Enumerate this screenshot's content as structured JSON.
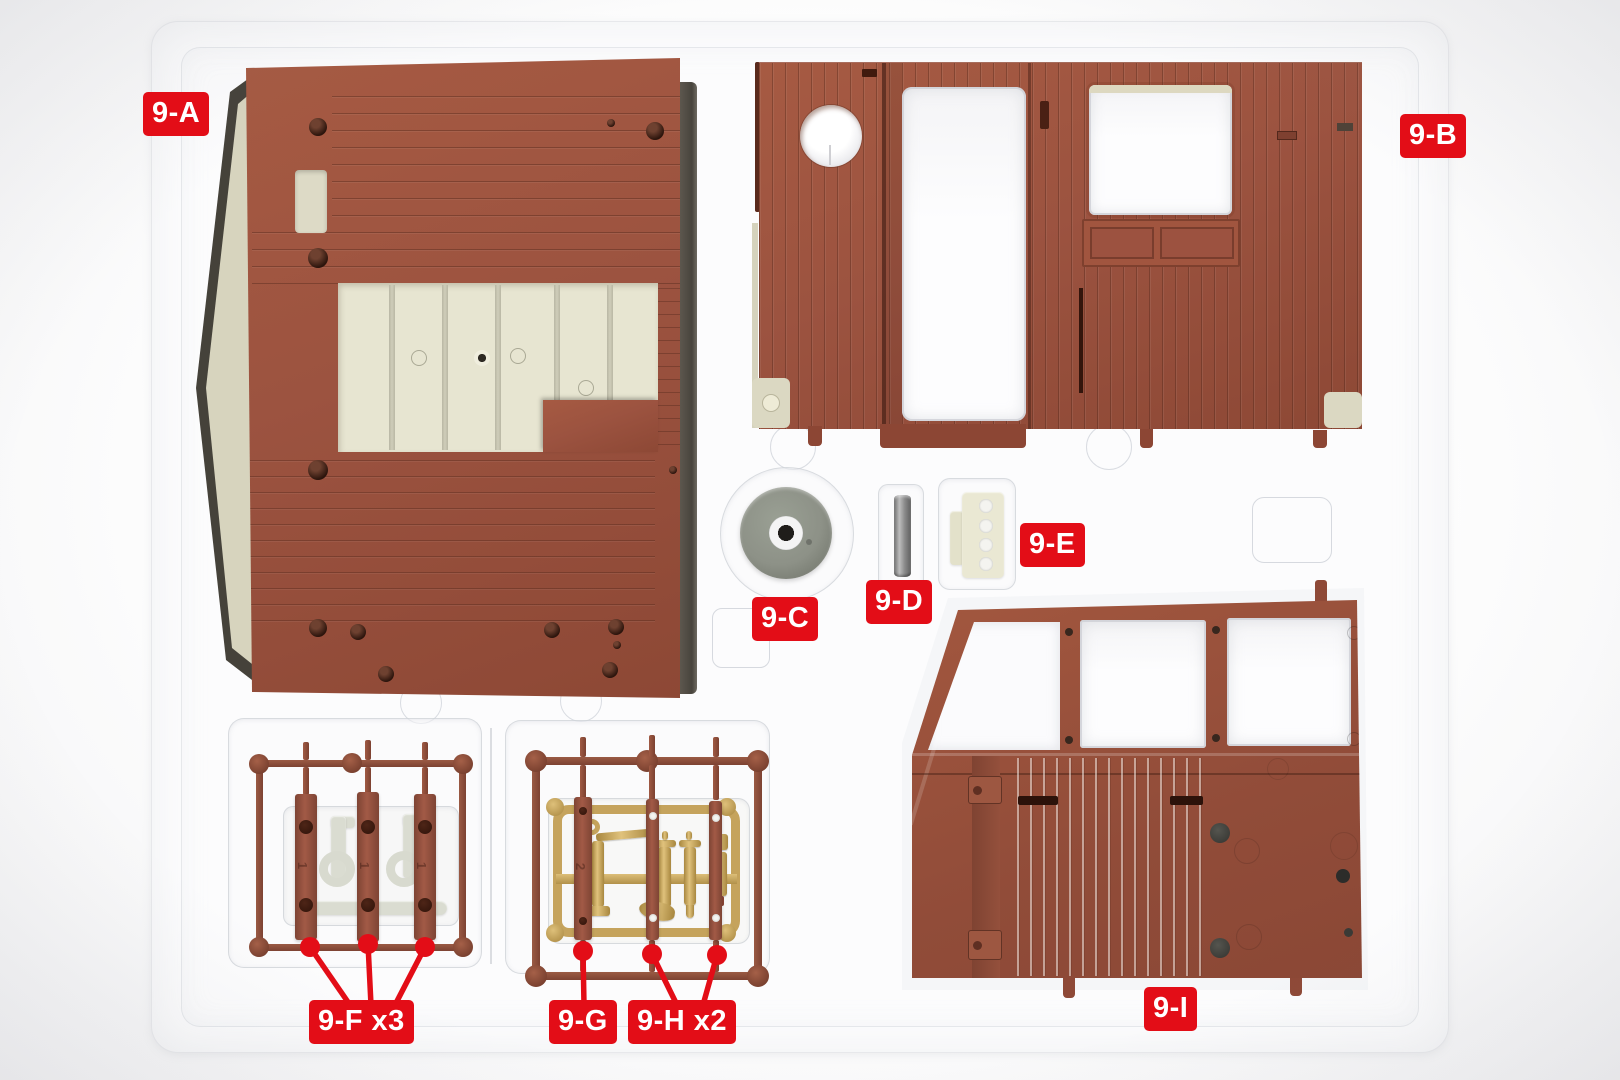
{
  "colors": {
    "label_red": "#e30d17",
    "panel_brown": "#9c5340",
    "panel_brown_dark": "#86432f",
    "runner_brown": "#8a4c3a",
    "cream": "#e7e5d1",
    "beige": "#d7d4be",
    "gold": "#c5a35c",
    "gold_light": "#e0c27c",
    "gray_part": "#8d9187",
    "tray_line": "#d4d7dd",
    "background": "#f2f2f4",
    "white_part": "#fbfbfd"
  },
  "labels": {
    "a": {
      "text": "9-A"
    },
    "b": {
      "text": "9-B"
    },
    "c": {
      "text": "9-C"
    },
    "d": {
      "text": "9-D"
    },
    "e": {
      "text": "9-E"
    },
    "f": {
      "text": "9-F x3"
    },
    "g": {
      "text": "9-G"
    },
    "h": {
      "text": "9-H x2"
    },
    "i": {
      "text": "9-I"
    }
  },
  "molded_marks": {
    "f_slat": "1",
    "g_bar": "2"
  },
  "parts": [
    {
      "id": "9-A",
      "quantity": 1
    },
    {
      "id": "9-B",
      "quantity": 1
    },
    {
      "id": "9-C",
      "quantity": 1
    },
    {
      "id": "9-D",
      "quantity": 1
    },
    {
      "id": "9-E",
      "quantity": 1
    },
    {
      "id": "9-F",
      "quantity": 3
    },
    {
      "id": "9-G",
      "quantity": 1
    },
    {
      "id": "9-H",
      "quantity": 2
    },
    {
      "id": "9-I",
      "quantity": 1
    }
  ]
}
